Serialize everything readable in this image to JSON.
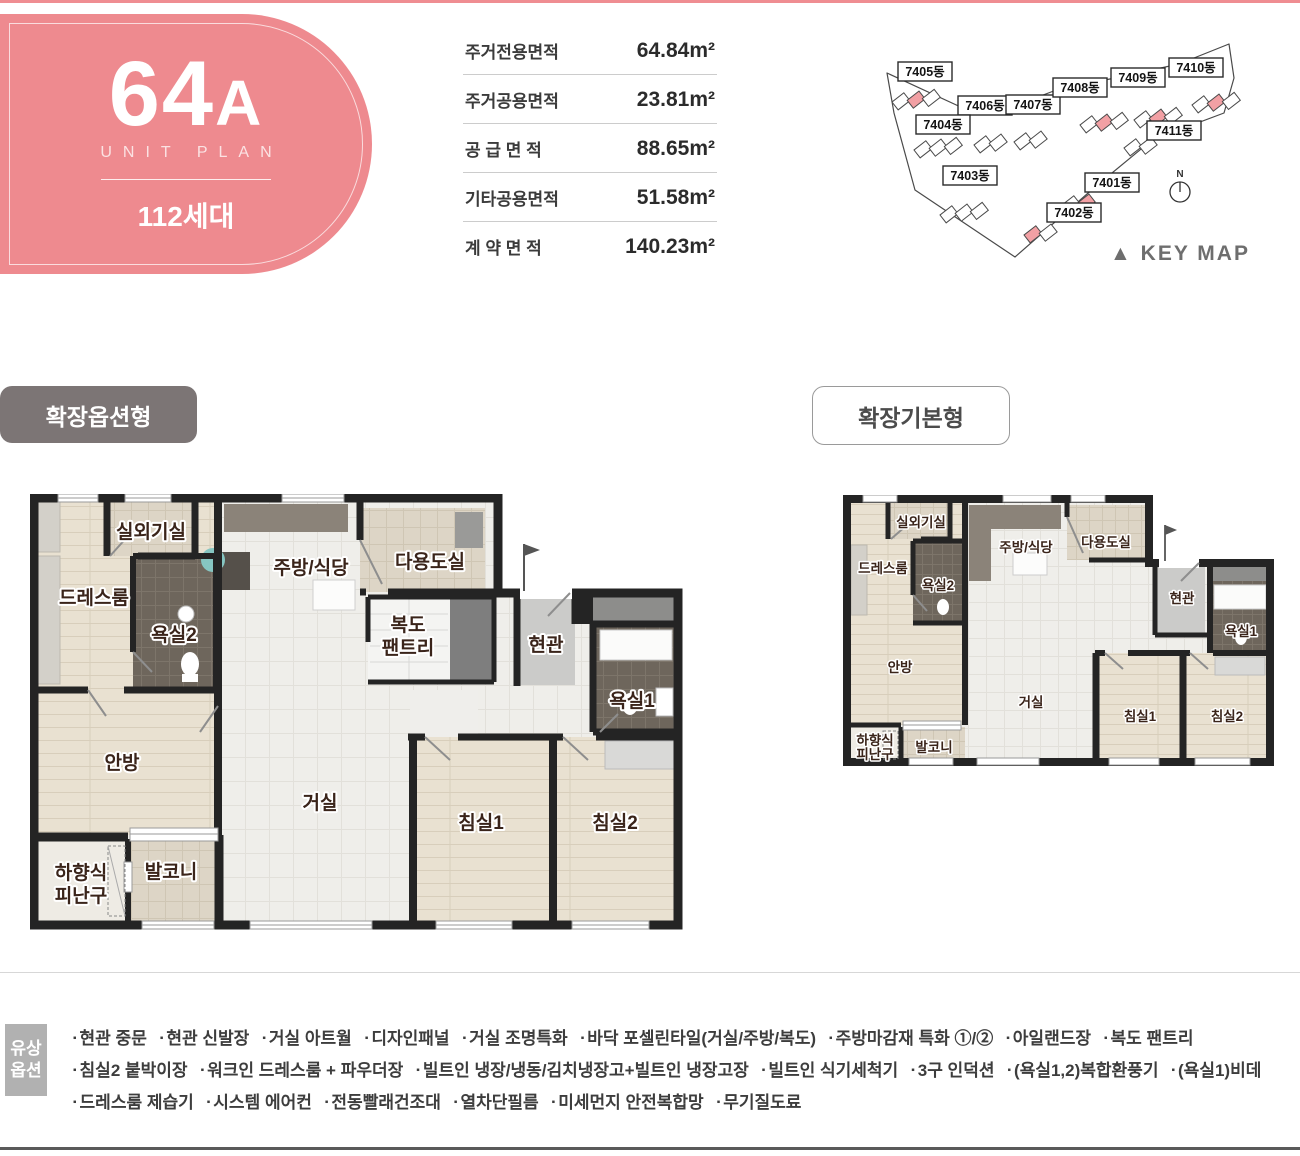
{
  "badge": {
    "code": "64",
    "code_suffix": "A",
    "subtitle": "UNIT PLAN",
    "households": "112세대"
  },
  "area_table": {
    "rows": [
      {
        "label": "주거전용면적",
        "value": "64.84m²"
      },
      {
        "label": "주거공용면적",
        "value": "23.81m²"
      },
      {
        "label": "공 급 면 적",
        "value": "88.65m²"
      },
      {
        "label": "기타공용면적",
        "value": "51.58m²"
      },
      {
        "label": "계 약 면 적",
        "value": "140.23m²"
      }
    ]
  },
  "keymap": {
    "buildings": [
      "7405동",
      "7406동",
      "7407동",
      "7404동",
      "7408동",
      "7409동",
      "7410동",
      "7411동",
      "7403동",
      "7401동",
      "7402동"
    ],
    "north": "N",
    "caption": "▲ KEY MAP"
  },
  "sections": {
    "option": "확장옵션형",
    "basic": "확장기본형"
  },
  "rooms": {
    "outdoor": "실외기실",
    "dress": "드레스룸",
    "bath2": "욕실2",
    "kitchen": "주방/식당",
    "utility": "다용도실",
    "pantry_l1": "복도",
    "pantry_l2": "팬트리",
    "entry": "현관",
    "bath1": "욕실1",
    "master": "안방",
    "living": "거실",
    "bed1": "침실1",
    "bed2": "침실2",
    "hatch_l1": "하향식",
    "hatch_l2": "피난구",
    "balcony": "발코니"
  },
  "options": {
    "box_l1": "유상",
    "box_l2": "옵션",
    "bullet": "▪",
    "lines": [
      [
        "현관 중문",
        "현관 신발장",
        "거실 아트월",
        "디자인패널",
        "거실 조명특화",
        "바닥 포셀린타일(거실/주방/복도)",
        "주방마감재 특화 ①/②",
        "아일랜드장",
        "복도 팬트리"
      ],
      [
        "침실2 붙박이장",
        "워크인 드레스룸 + 파우더장",
        "빌트인 냉장/냉동/김치냉장고+빌트인 냉장고장",
        "빌트인 식기세척기",
        "3구 인덕션",
        "(욕실1,2)복합환풍기",
        "(욕실1)비데"
      ],
      [
        "드레스룸 제습기",
        "시스템 에어컨",
        "전동빨래건조대",
        "열차단필름",
        "미세먼지 안전복합망",
        "무기질도료"
      ]
    ]
  },
  "colors": {
    "accent_pink": "#ee8a8f",
    "highlight_pink": "#f2a0a4",
    "wall": "#242424",
    "title_gray": "#7c7575"
  }
}
